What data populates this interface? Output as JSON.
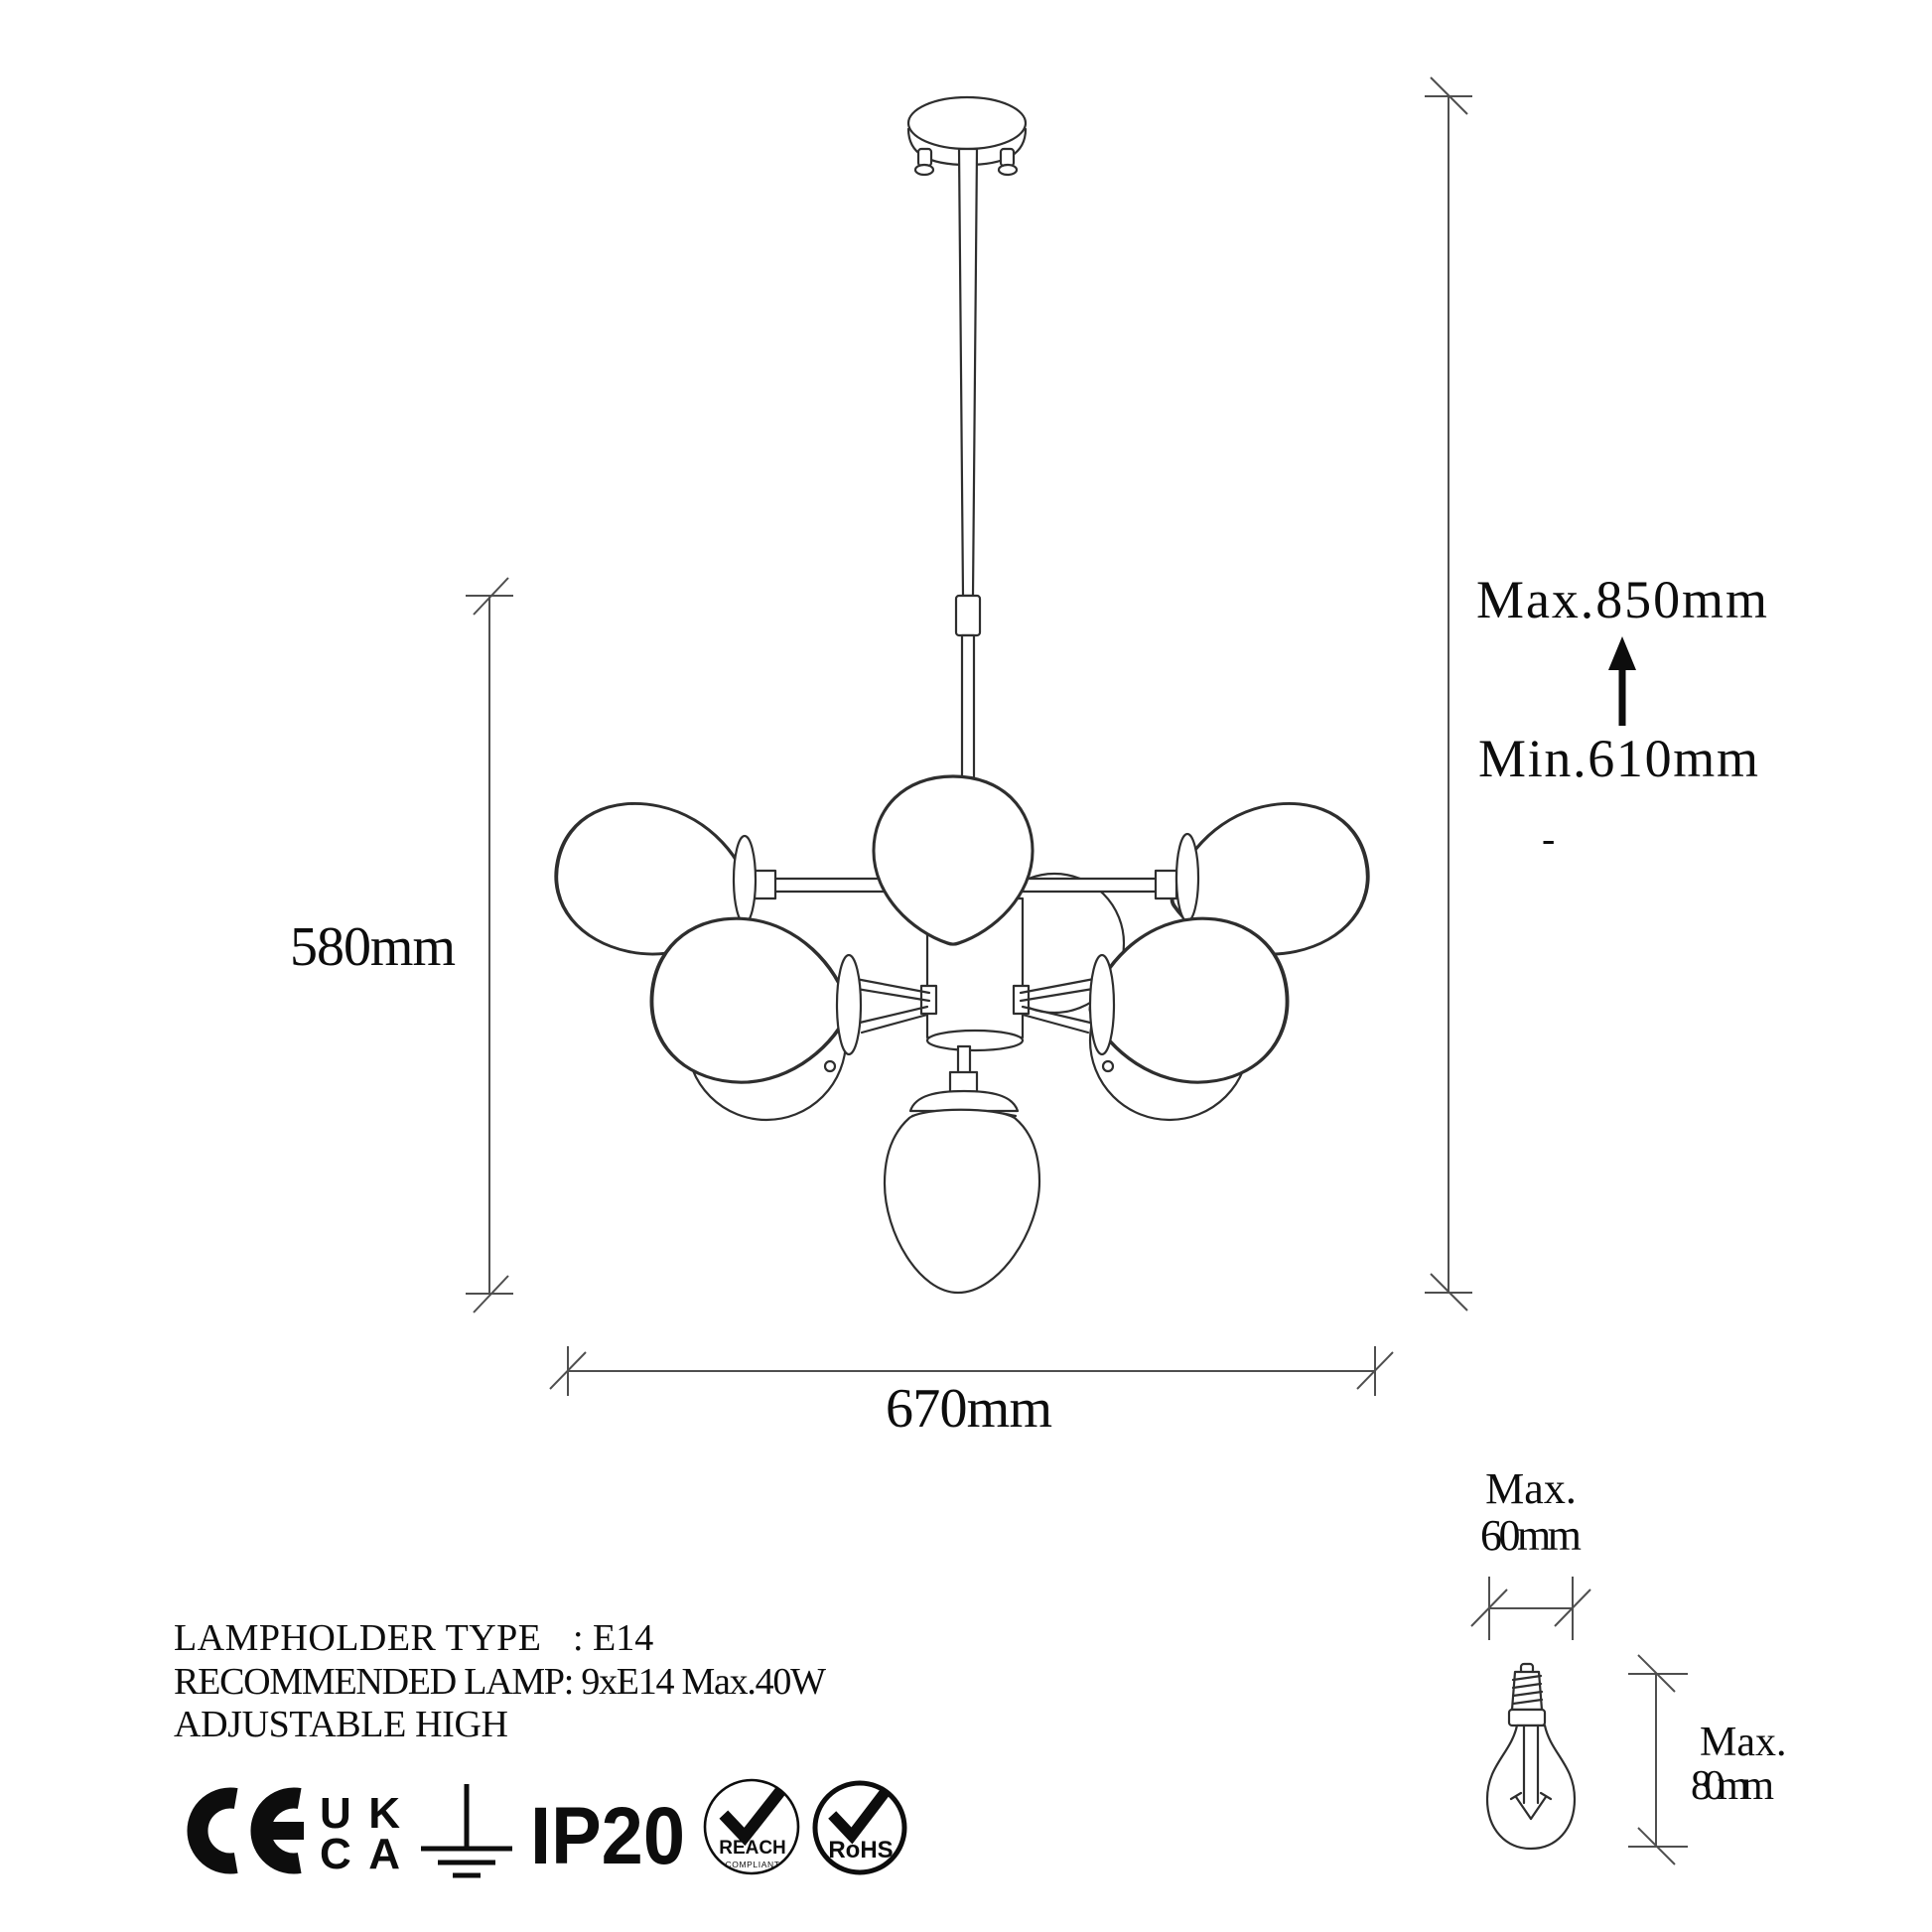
{
  "title": "Chandelier technical dimension drawing",
  "labels": {
    "height_max": "Max.850mm",
    "height_min": "Min.610mm",
    "dash": "-",
    "fixture_height": "580mm",
    "fixture_width": "670mm",
    "bulb_width_max": "Max.",
    "bulb_width_value": "60mm",
    "bulb_height_max": "Max.",
    "bulb_height_value": "80mm"
  },
  "specs": {
    "lampholder_label": "LAMPHOLDER TYPE",
    "lampholder_value": ": E14",
    "recommended_lamp": "RECOMMENDED LAMP: 9xE14 Max.40W",
    "adjustable": "ADJUSTABLE HIGH"
  },
  "badges": {
    "ce": "CE",
    "ukca_line1": "UK",
    "ukca_line2": "CA",
    "earth": "earth-ground-symbol",
    "ip_rating": "IP20",
    "reach": "REACH",
    "reach_sub": "COMPLIANT",
    "rohs": "RoHS"
  },
  "colors": {
    "background": "#ffffff",
    "drawing_line": "#2e2e2e",
    "dimension_line": "#4f4f4f",
    "text": "#0d0d0d"
  }
}
